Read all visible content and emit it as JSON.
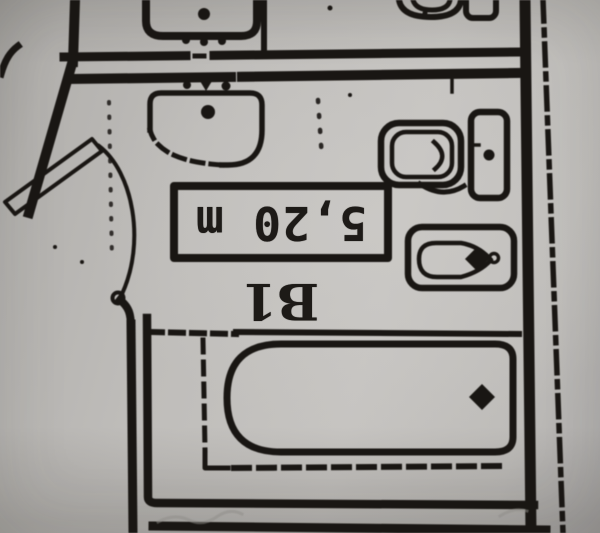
{
  "plan": {
    "room_label": "B1",
    "area_label": "5,20 m",
    "colors": {
      "ink": "#1d1a17",
      "paper": "#bcbab7"
    },
    "fixtures": {
      "upper_bathroom": [
        "washbasin",
        "toilet",
        "cistern"
      ],
      "room_b1": [
        "washbasin",
        "toilet",
        "cistern",
        "bidet",
        "bathtub",
        "entry-door"
      ]
    }
  }
}
